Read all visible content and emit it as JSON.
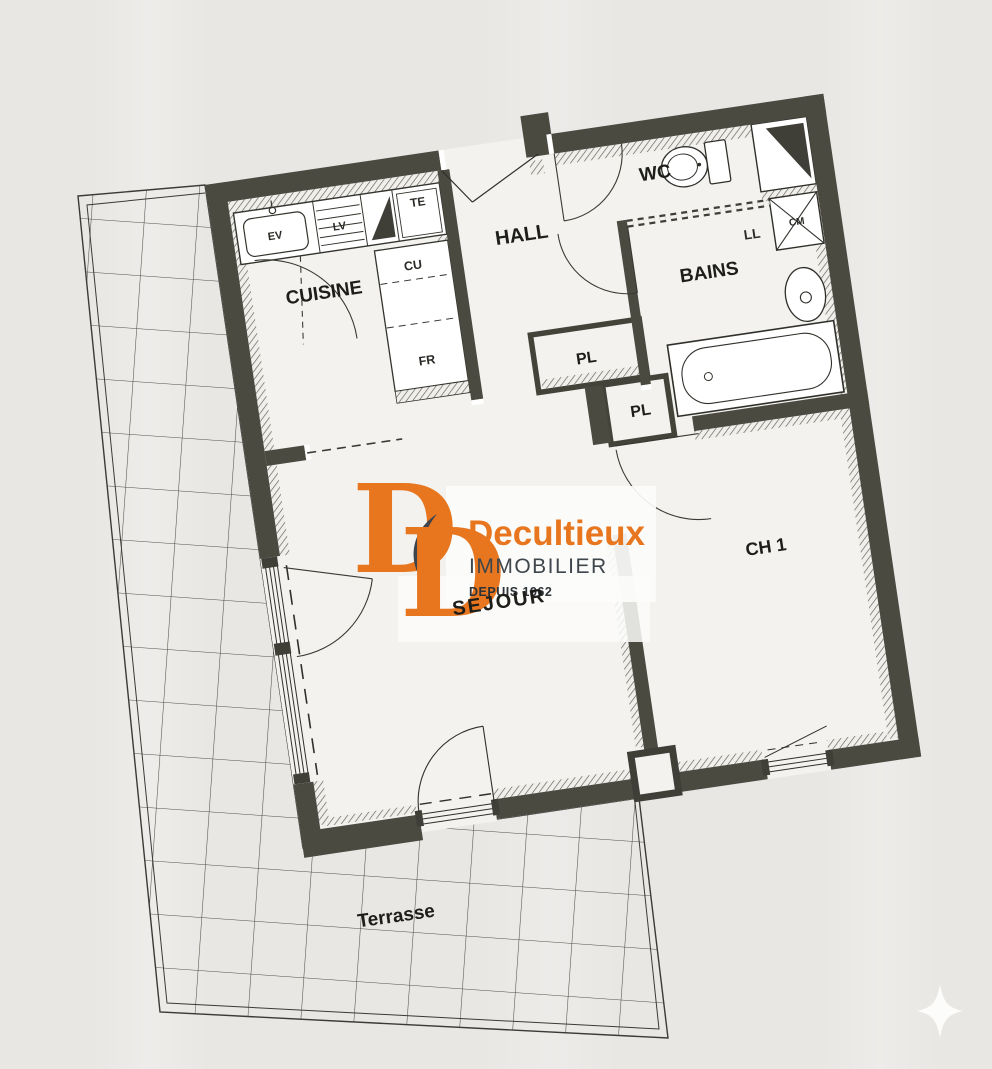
{
  "rooms": {
    "cuisine": "CUISINE",
    "hall": "HALL",
    "wc": "WC",
    "bains": "BAINS",
    "pl1": "PL",
    "pl2": "PL",
    "ch1": "CH 1",
    "sejour": "SEJOUR",
    "terrasse": "Terrasse"
  },
  "equipment": {
    "ev": "EV",
    "lv": "LV",
    "te": "TE",
    "cu": "CU",
    "fr": "FR",
    "ll": "LL",
    "cm": "CM"
  },
  "logo": {
    "monogram_letter": "D",
    "name": "Decultieux",
    "subtitle": "IMMOBILIER",
    "tagline": "DEPUIS 1962"
  },
  "colors": {
    "paper": "#e9e7e4",
    "interior": "#f3f2ef",
    "wall": "#4b4a41",
    "line": "#2f2f2a",
    "orange": "#E7761F",
    "slate": "#3d444d"
  }
}
